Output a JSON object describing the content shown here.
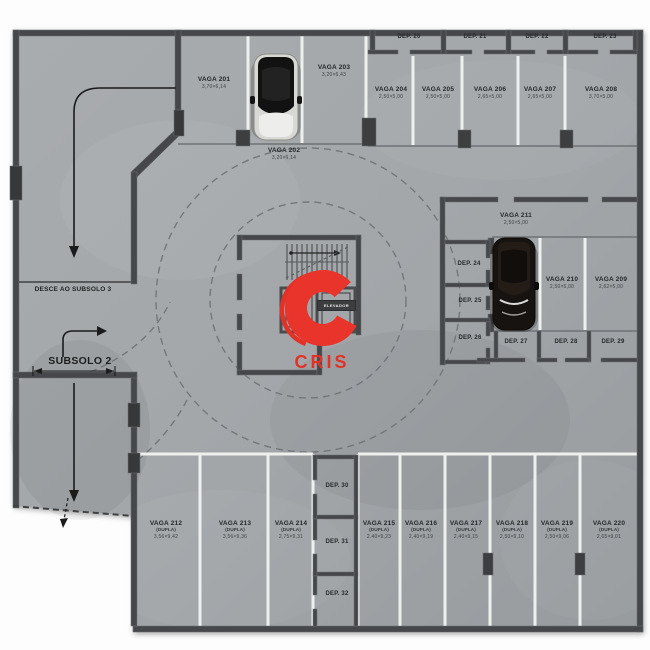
{
  "floor": {
    "subsolo_label": "SUBSOLO 2",
    "ramp_label": "DESCE AO SUBSOLO 3",
    "elevator_label": "ELEVADOR",
    "logo_text": "CRIS"
  },
  "colors": {
    "floor": "#a3a7aa",
    "wall": "#45474a",
    "separator_white": "#eef0ee",
    "accent_red": "#e23227",
    "text_dark": "#26282a"
  },
  "stalls": [
    {
      "name": "VAGA 201",
      "dims": "3,70×6,14"
    },
    {
      "name": "VAGA 202",
      "dims": "3,20×6,14"
    },
    {
      "name": "VAGA 203",
      "dims": "3,20×6,43"
    },
    {
      "name": "VAGA 204",
      "dims": "2,50×5,00"
    },
    {
      "name": "VAGA 205",
      "dims": "2,50×5,00"
    },
    {
      "name": "VAGA 206",
      "dims": "2,65×5,00"
    },
    {
      "name": "VAGA 207",
      "dims": "2,65×5,00"
    },
    {
      "name": "VAGA 208",
      "dims": "3,70×5,00"
    },
    {
      "name": "VAGA 209",
      "dims": "2,62×5,00"
    },
    {
      "name": "VAGA 210",
      "dims": "2,50×5,00"
    },
    {
      "name": "VAGA 211",
      "dims": "2,50×5,00"
    },
    {
      "name": "VAGA 212",
      "sub": "(DUPLA)",
      "dims": "3,56×9,42"
    },
    {
      "name": "VAGA 213",
      "sub": "(DUPLA)",
      "dims": "3,56×9,36"
    },
    {
      "name": "VAGA 214",
      "sub": "(DUPLA)",
      "dims": "2,75×9,31"
    },
    {
      "name": "VAGA 215",
      "sub": "(DUPLA)",
      "dims": "2,40×9,23"
    },
    {
      "name": "VAGA 216",
      "sub": "(DUPLA)",
      "dims": "2,40×9,19"
    },
    {
      "name": "VAGA 217",
      "sub": "(DUPLA)",
      "dims": "2,40×9,15"
    },
    {
      "name": "VAGA 218",
      "sub": "(DUPLA)",
      "dims": "2,50×9,10"
    },
    {
      "name": "VAGA 219",
      "sub": "(DUPLA)",
      "dims": "2,50×9,06"
    },
    {
      "name": "VAGA 220",
      "sub": "(DUPLA)",
      "dims": "2,65×9,01"
    }
  ],
  "deps": [
    {
      "name": "DEP. 20"
    },
    {
      "name": "DEP. 21"
    },
    {
      "name": "DEP. 22"
    },
    {
      "name": "DEP. 23"
    },
    {
      "name": "DEP. 24"
    },
    {
      "name": "DEP. 25"
    },
    {
      "name": "DEP. 26"
    },
    {
      "name": "DEP. 27"
    },
    {
      "name": "DEP. 28"
    },
    {
      "name": "DEP. 29"
    },
    {
      "name": "DEP. 30"
    },
    {
      "name": "DEP. 31"
    },
    {
      "name": "DEP. 32"
    }
  ]
}
